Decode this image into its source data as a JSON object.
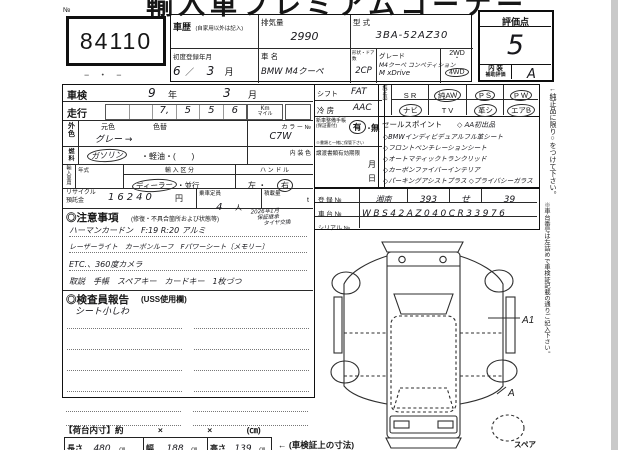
{
  "title": "輸入車プレミアムコーナー",
  "lot": {
    "no_label": "№",
    "number": "84110",
    "dashes": "−　・　−"
  },
  "header": {
    "history_label": "車歴",
    "history_note": "(自家用以外は記入)",
    "disp_label": "排気量",
    "disp_value": "2990",
    "model_label": "型 式",
    "model_value": "3BA-52AZ30",
    "firstreg_label": "初度登録年月",
    "firstreg_value": "6",
    "firstreg_slash": "／",
    "firstreg_month": "3",
    "month_suffix": "月",
    "name_label": "車 名",
    "name_value": "BMW M4クーペ",
    "shape_label": "形状・ドア数",
    "shape_value": "2CP",
    "grade_label": "グレード",
    "grade_line1": "M4クーペ コンペティション",
    "grade_line2": "M xDrive",
    "drive_2wd": "2WD",
    "drive_sep": "・",
    "drive_4wd": "4WD",
    "drive_4wd_circled": true
  },
  "score": {
    "label": "評価点",
    "value": "5",
    "interior_label1": "内 装",
    "interior_label2": "補助評価",
    "interior_value": "A"
  },
  "inspection": {
    "label": "車検",
    "year": "9",
    "year_suffix": "年",
    "month": "3",
    "month_suffix": "月"
  },
  "mileage": {
    "label": "走行",
    "d1": "",
    "d2": "",
    "d3": "7,",
    "d4": "5",
    "d5": "5",
    "d6": "6",
    "unit_top": "Km",
    "unit_bottom": "マイル"
  },
  "color": {
    "label": "外色",
    "orig_label": "元色",
    "change_label": "色替",
    "value": "グレー →",
    "no_label": "カ ラ ー №",
    "no_value": "C7W"
  },
  "fuel": {
    "label": "燃料",
    "selected": "ガソリン",
    "selected_circled": true,
    "rest": "・軽油・(　　)",
    "interior_label": "内 装 色"
  },
  "import": {
    "label": "輸入車用",
    "year_label": "年式",
    "class_label": "輸 入 区 分",
    "dealer": "ディーラー",
    "dealer_circled": true,
    "parallel": "・並行",
    "handle_label": "ハ ン ド ル",
    "left": "左 ・",
    "right": "右",
    "right_circled": true
  },
  "recycle": {
    "label1": "リサイクル",
    "label2": "預託金",
    "value": "16240",
    "unit": "円",
    "cap_label": "乗車定員",
    "cap_value": "4",
    "cap_unit": "人",
    "load_label": "積載量",
    "load_unit": "t"
  },
  "notes": {
    "title": "◎注意事項",
    "subtitle": "(修復・不具合箇所および状態等)",
    "corner1": "2026年1月",
    "corner2": "保証継承",
    "corner3": "タイヤ交換",
    "line1": "ハーマンカードン　F:19 R:20 アルミ",
    "line2": "レーザーライト　カーボンルーフ　Fパワーシート〔メモリー〕",
    "line3": "ETC.、360度カメラ",
    "line4": "取説　手帳　スペアキー　カードキー　1枚づつ"
  },
  "inspector": {
    "title": "◎検査員報告",
    "subtitle": "(USS使用欄)",
    "finding": "シート小しわ"
  },
  "mid": {
    "shift_label": "シフト",
    "shift_value": "FAT",
    "ac_label": "冷 房",
    "ac_value": "AAC",
    "book_label1": "新車整備手帳",
    "book_label2": "(保証書付)",
    "book_yes": "有",
    "book_yes_circled": true,
    "book_sep": "・",
    "book_no": "無",
    "book_note": "※書類と一緒に保管下さい",
    "transfer_label": "譲渡書類有効期限",
    "transfer_month": "月",
    "transfer_day": "日"
  },
  "equip": {
    "label": "純正品",
    "cells": [
      {
        "t": "S R",
        "c": false
      },
      {
        "t": "純AW",
        "c": true
      },
      {
        "t": "P S",
        "c": true
      },
      {
        "t": "P W",
        "c": true
      },
      {
        "t": "ナビ",
        "c": true
      },
      {
        "t": "T V",
        "c": false
      },
      {
        "t": "革シ",
        "c": true
      },
      {
        "t": "エアB",
        "c": true
      }
    ]
  },
  "sales": {
    "label": "セールスポイント",
    "point0": "◇ AA初出品",
    "point1": "◇BMWインディビデュアルフル革シート",
    "point2": "◇フロントベンチレーションシート",
    "point3": "◇オートマティックトランクリッド",
    "point4": "◇カーボンファイバーインテリア",
    "point5": "◇パーキングアシストプラス ◇プライバシーガラス"
  },
  "reg": {
    "label": "登 録 №",
    "v1": "湘南",
    "v2": "393",
    "v3": "せ",
    "v4": "39",
    "chassis_label": "車 台 №",
    "chassis_value": "WBS42AZ040CR33976",
    "serial_label": "シリアル №",
    "serial_value": ""
  },
  "dims": {
    "bed_label": "【荷台内寸】約",
    "x1": "×",
    "x2": "×",
    "unit": "(㎝)",
    "len_label": "長さ",
    "len_value": "480",
    "w_label": "幅",
    "w_value": "188",
    "h_label": "高さ",
    "h_value": "139",
    "cm": "㎝",
    "note": "← (車検証上の寸法)"
  },
  "margin": {
    "note1": "←純正品に限り○をつけて下さい。",
    "note2": "※車台番号は左詰めで車検証記載の通りご記入下さい。"
  },
  "diagram": {
    "a1": "A1",
    "a": "A",
    "spare": "スペア"
  }
}
